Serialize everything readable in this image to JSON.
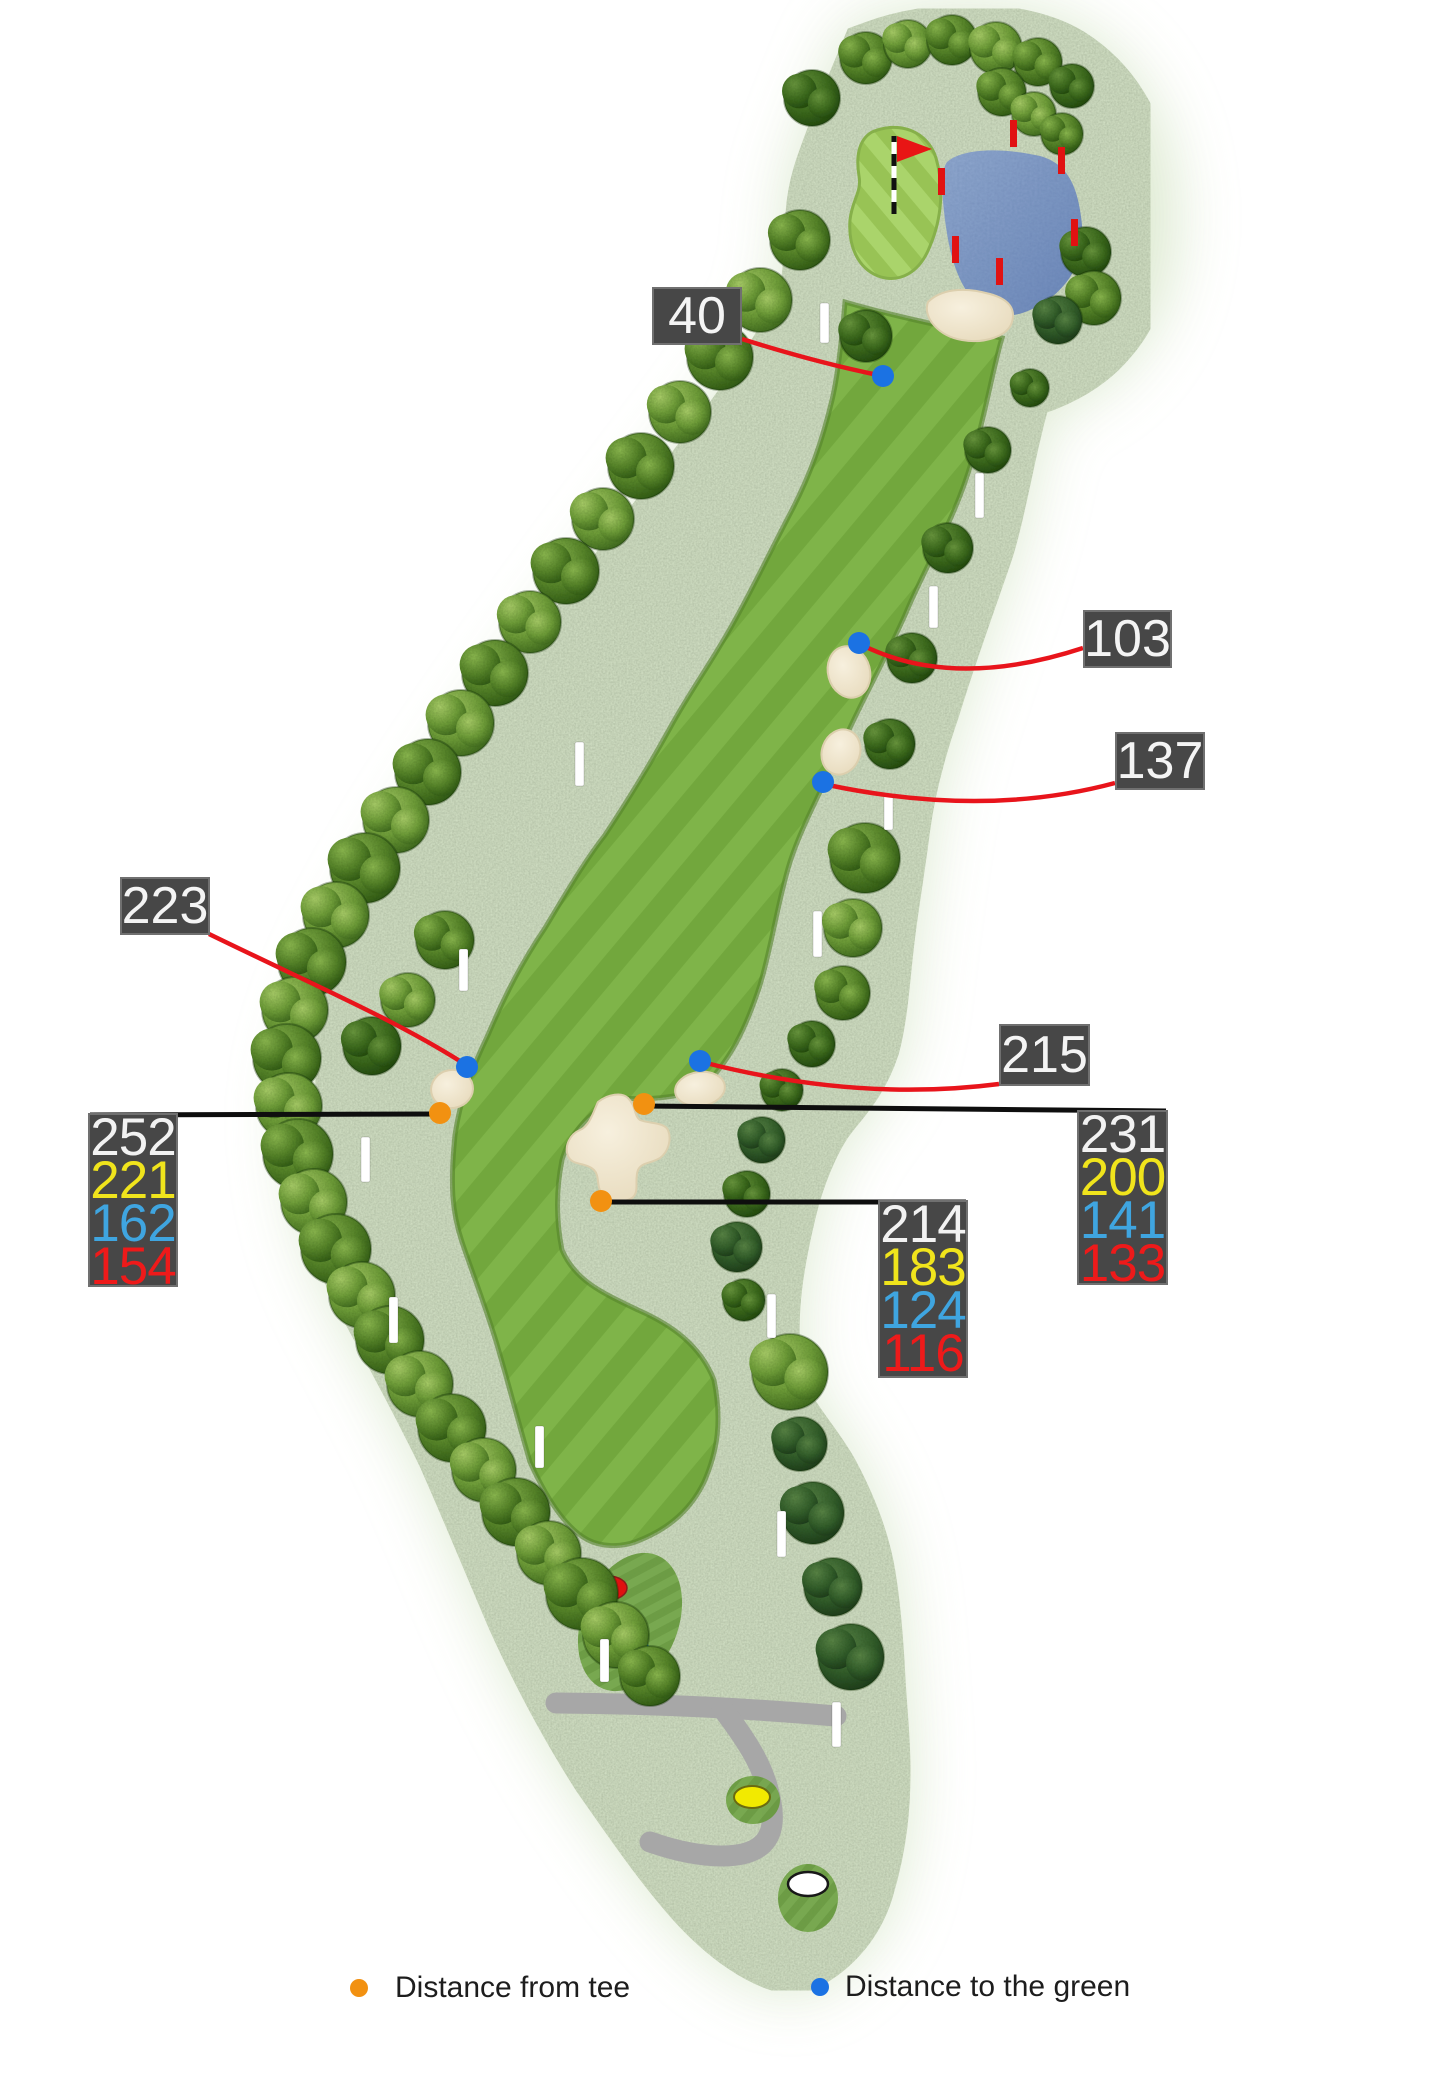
{
  "title": "golf-hole-distance-map",
  "callouts": [
    {
      "id": "c40",
      "value": "40"
    },
    {
      "id": "c103",
      "value": "103"
    },
    {
      "id": "c137",
      "value": "137"
    },
    {
      "id": "c223",
      "value": "223"
    },
    {
      "id": "c215",
      "value": "215"
    }
  ],
  "distance_boxes": {
    "left": {
      "values": [
        "252",
        "221",
        "162",
        "154"
      ]
    },
    "right": {
      "values": [
        "231",
        "200",
        "141",
        "133"
      ]
    },
    "middle": {
      "values": [
        "214",
        "183",
        "124",
        "116"
      ]
    }
  },
  "value_colors": {
    "tee_white": "#f2f2f2",
    "tee_yellow": "#f0e41c",
    "tee_blue": "#3fa5e0",
    "tee_red": "#ee1a1a"
  },
  "markers": {
    "orange_dot_color": "#f29111",
    "blue_dot_color": "#1b72e3",
    "leader_red": "#e8141b",
    "leader_black": "#0e0e0e"
  },
  "legend": {
    "from_tee": {
      "label": "Distance from tee",
      "color": "#f29111"
    },
    "to_green": {
      "label": "Distance to the green",
      "color": "#1b72e3"
    }
  }
}
